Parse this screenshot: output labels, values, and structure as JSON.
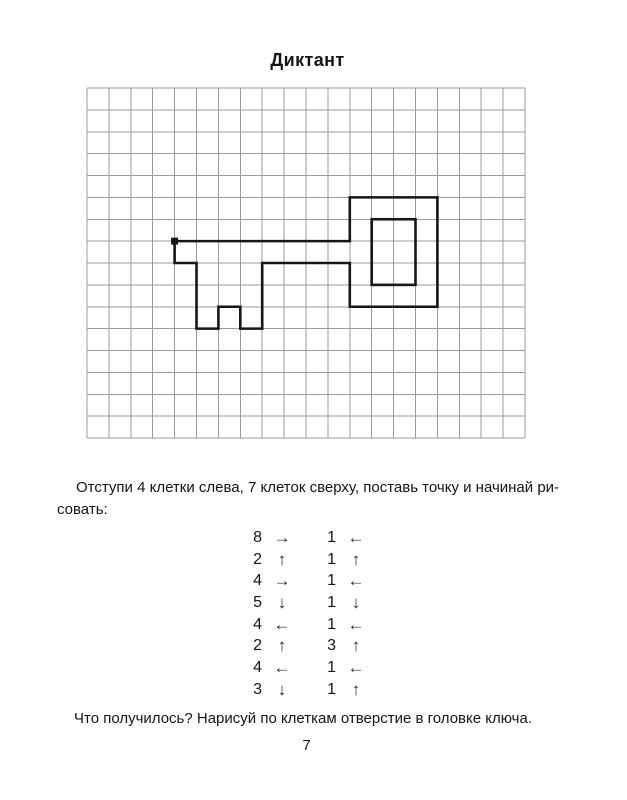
{
  "title": "Диктант",
  "instruction": {
    "line1": "Отступи 4 клетки слева, 7 клеток сверху, поставь точку и начинай ри-",
    "line2": "совать:"
  },
  "dictation_steps": {
    "left": [
      [
        "8",
        "→"
      ],
      [
        "2",
        "↑"
      ],
      [
        "4",
        "→"
      ],
      [
        "5",
        "↓"
      ],
      [
        "4",
        "←"
      ],
      [
        "2",
        "↑"
      ],
      [
        "4",
        "←"
      ],
      [
        "3",
        "↓"
      ]
    ],
    "right": [
      [
        "1",
        "←"
      ],
      [
        "1",
        "↑"
      ],
      [
        "1",
        "←"
      ],
      [
        "1",
        "↓"
      ],
      [
        "1",
        "←"
      ],
      [
        "3",
        "↑"
      ],
      [
        "1",
        "←"
      ],
      [
        "1",
        "↑"
      ]
    ]
  },
  "question": "Что получилось? Нарисуй по клеткам отверстие в головке ключа.",
  "page_number": "7",
  "grid": {
    "cols": 20,
    "rows": 16,
    "line_color": "#9b9b9b"
  },
  "figure": {
    "name": "key-outline",
    "color": "#161616",
    "stroke_width": 2.6,
    "start_point": [
      4,
      7
    ],
    "outline": [
      [
        4,
        7
      ],
      [
        12,
        7
      ],
      [
        12,
        5
      ],
      [
        16,
        5
      ],
      [
        16,
        10
      ],
      [
        12,
        10
      ],
      [
        12,
        8
      ],
      [
        8,
        8
      ],
      [
        8,
        11
      ],
      [
        7,
        11
      ],
      [
        7,
        10
      ],
      [
        6,
        10
      ],
      [
        6,
        11
      ],
      [
        5,
        11
      ],
      [
        5,
        8
      ],
      [
        4,
        8
      ]
    ],
    "hole_rect": {
      "from": [
        13,
        6
      ],
      "to": [
        15,
        9
      ]
    }
  }
}
